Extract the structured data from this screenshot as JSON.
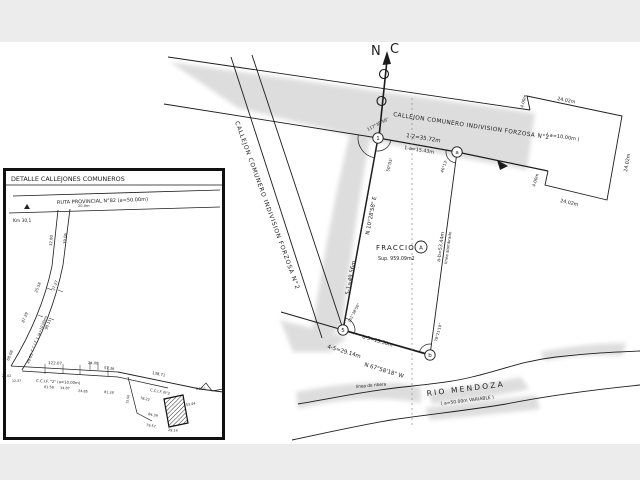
{
  "north": {
    "n": "N",
    "c": "C"
  },
  "main": {
    "road_top_name": "CALLEJON COMUNERO    INDIVISION FORZOSA N°2",
    "road_top_note": "( a=10.00m )",
    "road_left_name": "CALLEJON COMUNERO      INDIVISION FORZOSA N°2",
    "dim_step_top": "4.00m",
    "dim_top": "24.02m",
    "dim_right": "24.02m",
    "dim_bottom": "24.02m",
    "dim_step_bottom": "4.00m",
    "seg_1_2": "1-2=35.72m",
    "seg_1_a": "1-a=15.43m",
    "angle_1": "117°39'56\"",
    "angle_1_road": "50°05'",
    "angle_a": "46°13'",
    "v_1": "1",
    "v_a": "a",
    "v_5": "5",
    "v_b": "b",
    "parcel_title": "FRACCION",
    "parcel_letter": "A",
    "parcel_area": "Sup. 959.09m2",
    "side_left_bearing": "N 10°28'58\" E",
    "side_left_len": "5-1=49.56m",
    "side_right_len": "a-b=53.44m",
    "side_right_note": "linea alambrado",
    "side_bottom_len": "b-5=15.50m",
    "angle_5": "101°38'50\"",
    "angle_b": "78°21'10\"",
    "seg_4_5": "4-5=29.14m",
    "bearing_bottom": "N 67°58'18\" W",
    "shore_note": "linea de ribera",
    "river_name": "RIO MENDOZA",
    "river_note": "( a=50.00m VARIABLE )"
  },
  "inset": {
    "title": "DETALLE CALLEJONES COMUNEROS",
    "route_name": "RUTA PROVINCIAL N°82 (a=50.00m)",
    "km_label": "Km 30,1",
    "top_width": "20.0m",
    "ccif1_name": "C.C.I.F. 1 (a=10.00m)",
    "ccif2_name": "C.C.I.F. \"2\" (a=10.00m)",
    "ccif2b_name": "C.C.I.F. N°2",
    "m": [
      "32.80",
      "39.06",
      "25.58",
      "37.27",
      "87.29",
      "98.11",
      "68.08",
      "49.05",
      "122.07",
      "24.00",
      "57.36",
      "61.58",
      "34.87",
      "24.85",
      "81.28",
      "138.71",
      "78.22",
      "15.50",
      "12.57",
      "24.02",
      "24.02",
      "53.44",
      "84.39",
      "79.57",
      "29.14"
    ]
  },
  "colors": {
    "ink": "#1c1c1c",
    "shade": "#d8d8d8",
    "paper": "#ffffff",
    "band": "#ececec"
  }
}
